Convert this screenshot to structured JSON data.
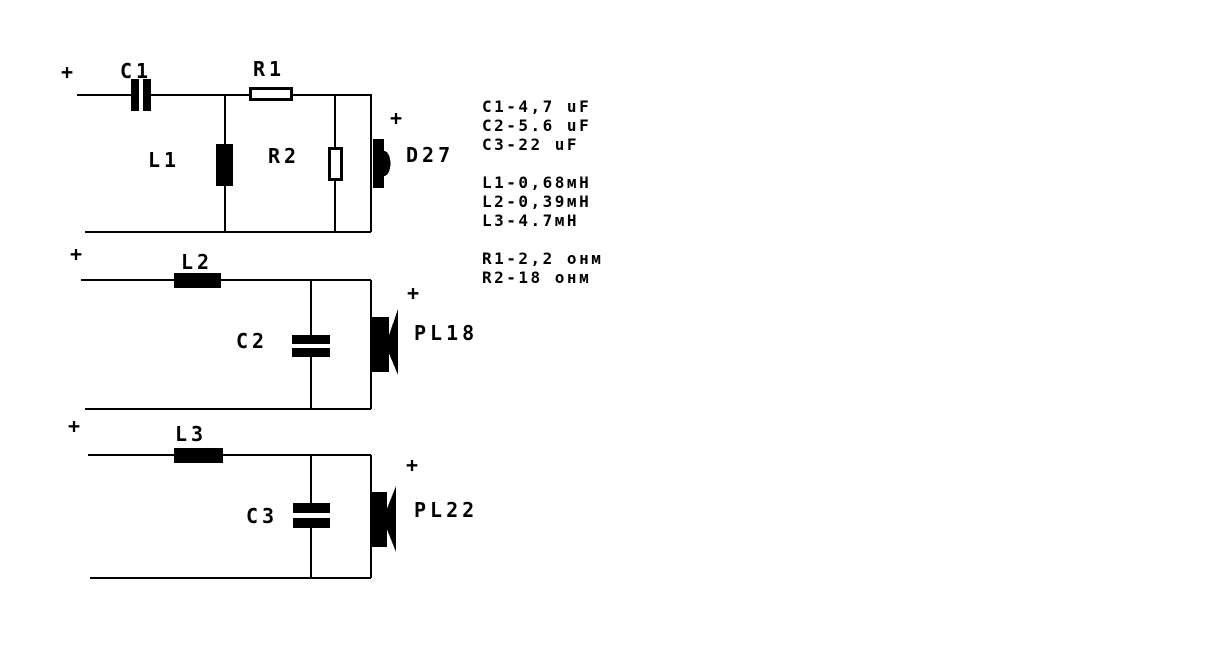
{
  "symbols": {
    "plus": "+"
  },
  "circuits": {
    "tweeter": {
      "series_capacitor": "C1",
      "series_resistor": "R1",
      "shunt_inductor": "L1",
      "shunt_resistor": "R2",
      "speaker": "D27"
    },
    "mid": {
      "series_inductor": "L2",
      "shunt_capacitor": "C2",
      "speaker": "PL18"
    },
    "woofer": {
      "series_inductor": "L3",
      "shunt_capacitor": "C3",
      "speaker": "PL22"
    }
  },
  "legend": {
    "capacitors": [
      "C1-4,7 uF",
      "C2-5.6 uF",
      "C3-22 uF"
    ],
    "inductors": [
      "L1-0,68мН",
      "L2-0,39мН",
      "L3-4.7мН"
    ],
    "resistors": [
      "R1-2,2 онм",
      "R2-18 онм"
    ]
  },
  "colors": {
    "ink": "#000000",
    "background": "#ffffff"
  }
}
